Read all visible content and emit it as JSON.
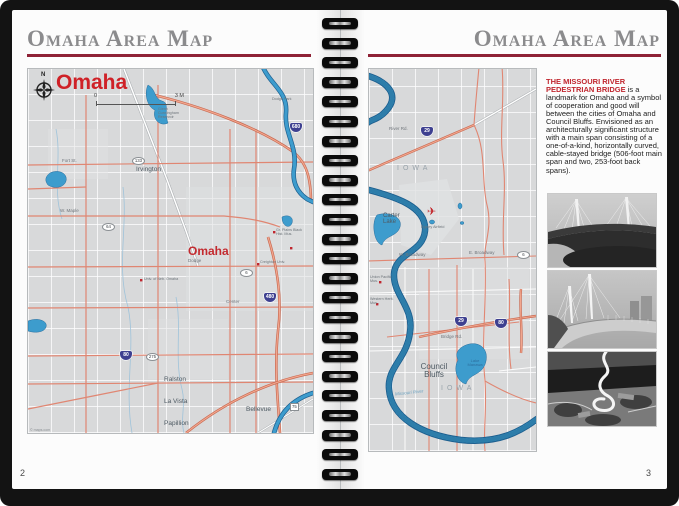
{
  "page": {
    "left_number": "2",
    "right_number": "3"
  },
  "headers": {
    "left_title": "Omaha Area Map",
    "right_title": "Omaha Area Map"
  },
  "left_map": {
    "compass_letter": "N",
    "city_title": "Omaha",
    "scale_start": "0",
    "scale_end": "3 M",
    "credit": "© maps.com",
    "labels": {
      "dodge_park": "Dodge Park",
      "cunningham": "Glenn Cunningham Reservoir",
      "irvington": "Irvington",
      "fort_st": "Fort St.",
      "w_maple": "W. Maple",
      "dodge": "Dodge",
      "center_st": "Center",
      "omaha_center": "Omaha",
      "univ_neb": "Univ. of Neb. Omaha",
      "creighton": "Creighton Univ.",
      "gr_plains": "Gr. Plains Black Hist. Mus.",
      "ralston": "Ralston",
      "la_vista": "La Vista",
      "papillion": "Papillion",
      "bellevue": "Bellevue"
    },
    "shields": {
      "i680": "680",
      "i480": "480",
      "i80": "80",
      "r133": "133",
      "r64": "64",
      "r6": "6",
      "r275": "275",
      "r75": "75"
    }
  },
  "right_map": {
    "airplane_icon": "✈",
    "labels": {
      "river_rd": "River Rd.",
      "iowa_top": "IOWA",
      "carter_lake": "Carter Lake",
      "eppley": "Eppley Airfield",
      "union_pacific": "Union Pacific Mus.",
      "western_herit": "Western Herit. Mus.",
      "w_broadway": "W. Broadway",
      "e_broadway": "E. Broadway",
      "bridge_rd": "Bridge Rd.",
      "council_bluffs": "Council Bluffs",
      "lake_manawa": "Lake Manawa",
      "missouri_river": "Missouri River",
      "iowa_bottom": "IOWA"
    },
    "shields": {
      "i29_top": "29",
      "i29_bot": "29",
      "i80": "80",
      "r6": "6"
    }
  },
  "article": {
    "lead": "THE MISSOURI RIVER PEDESTRIAN BRIDGE",
    "body": "is a landmark for Omaha and a symbol of cooperation and good will between the cities of Omaha and Council Bluffs. Envisioned as an architecturally significant structure with a main span consisting of a one-of-a-kind, horizontally curved, cable-stayed bridge (506-foot main span and two, 253-foot back spans)."
  },
  "photos": [
    {
      "name": "pedestrian-bridge-elevation-rendering"
    },
    {
      "name": "pedestrian-bridge-deck-rendering"
    },
    {
      "name": "pedestrian-bridge-aerial-rendering"
    }
  ],
  "colors": {
    "header_gray": "#8b8b8d",
    "rule_maroon": "#8e2236",
    "map_red": "#c32a2f",
    "water_blue": "#3d9ccd",
    "road_salmon": "#e08672",
    "shield_blue": "#3e4090"
  }
}
